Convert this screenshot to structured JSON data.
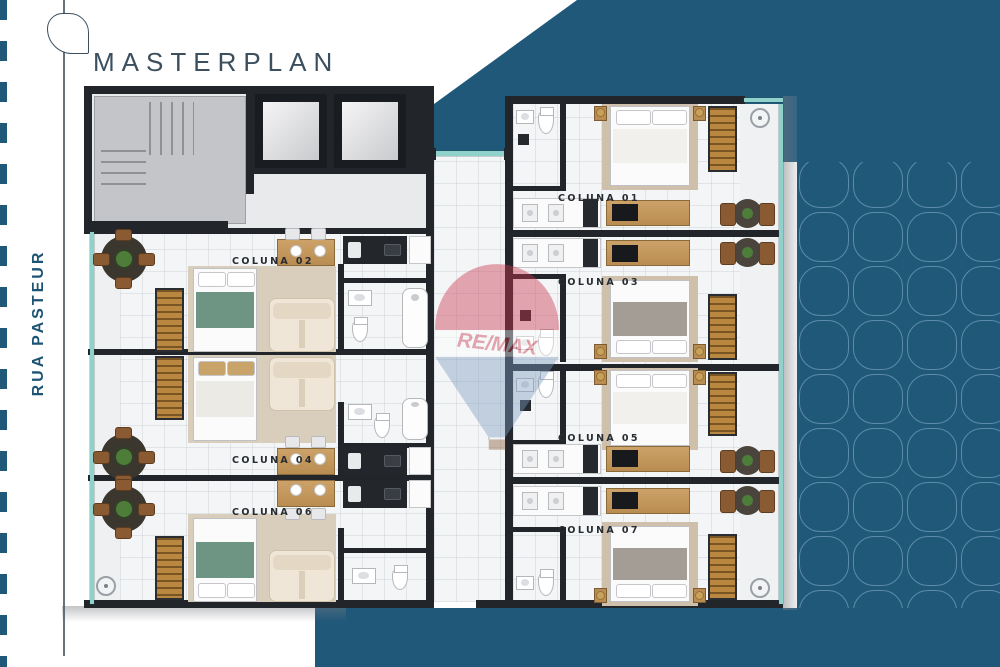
{
  "header": {
    "title": "MASTERPLAN"
  },
  "street": {
    "label": "RUA PASTEUR"
  },
  "watermark": {
    "brand": "RE/MAX"
  },
  "colors": {
    "blue": "#20587A",
    "pattern": "#5D8BAB",
    "street": "#1D5374",
    "labelc": "#282C31",
    "wall": "#22262B",
    "floor": "#F4F5F6",
    "glass": "#8FD2CC",
    "wood2": "#B9873F",
    "sofa": "#EFE6D7",
    "rug": "#D9CDBB",
    "bed_green": "#6E9484",
    "bed_gray": "#A39D96",
    "remax_red": "#C8374D",
    "remax_blue": "#7D9CC0"
  },
  "units": [
    {
      "id": "coluna-01",
      "label": "COLUNA 01",
      "x": 558,
      "y": 193
    },
    {
      "id": "coluna-02",
      "label": "COLUNA 02",
      "x": 232,
      "y": 256
    },
    {
      "id": "coluna-03",
      "label": "COLUNA 03",
      "x": 558,
      "y": 277
    },
    {
      "id": "coluna-04",
      "label": "COLUNA 04",
      "x": 232,
      "y": 455
    },
    {
      "id": "coluna-05",
      "label": "COLUNA 05",
      "x": 558,
      "y": 433
    },
    {
      "id": "coluna-06",
      "label": "COLUNA 06",
      "x": 232,
      "y": 507
    },
    {
      "id": "coluna-07",
      "label": "COLUNA 07",
      "x": 558,
      "y": 525
    }
  ],
  "plan": {
    "items": [
      {
        "t": "floor",
        "x": 92,
        "y": 94,
        "w": 336,
        "h": 138,
        "c": "#E9EAEC"
      },
      {
        "t": "floor",
        "x": 120,
        "y": 232,
        "w": 306,
        "h": 370
      },
      {
        "t": "floor",
        "x": 92,
        "y": 232,
        "w": 28,
        "h": 370,
        "c": "#EEF0F1"
      },
      {
        "t": "floor",
        "x": 434,
        "y": 156,
        "w": 71,
        "h": 446
      },
      {
        "t": "floor",
        "x": 513,
        "y": 104,
        "w": 227,
        "h": 498
      },
      {
        "t": "floor",
        "x": 740,
        "y": 104,
        "w": 41,
        "h": 498,
        "c": "#F0F1F2"
      },
      {
        "t": "shadow-b",
        "x": 62,
        "y": 606,
        "w": 284,
        "h": 16
      },
      {
        "t": "shadow-r",
        "x": 783,
        "y": 96,
        "w": 14,
        "h": 514
      },
      {
        "t": "stairs",
        "x": 94,
        "y": 96,
        "w": 152,
        "h": 128
      },
      {
        "t": "wall",
        "x": 246,
        "y": 86,
        "w": 8,
        "h": 108
      },
      {
        "t": "wall",
        "x": 88,
        "y": 221,
        "w": 140,
        "h": 7
      },
      {
        "t": "wall",
        "x": 248,
        "y": 86,
        "w": 186,
        "h": 88
      },
      {
        "t": "elevator",
        "x": 255,
        "y": 94,
        "w": 72,
        "h": 74
      },
      {
        "t": "elevator",
        "x": 334,
        "y": 94,
        "w": 72,
        "h": 74
      },
      {
        "t": "wall",
        "x": 84,
        "y": 86,
        "w": 350,
        "h": 8
      },
      {
        "t": "wall",
        "x": 84,
        "y": 86,
        "w": 8,
        "h": 146
      },
      {
        "t": "wall",
        "x": 426,
        "y": 86,
        "w": 8,
        "h": 522
      },
      {
        "t": "wall",
        "x": 84,
        "y": 600,
        "w": 350,
        "h": 8
      },
      {
        "t": "wall",
        "x": 84,
        "y": 228,
        "w": 350,
        "h": 6
      },
      {
        "t": "wall",
        "x": 88,
        "y": 349,
        "w": 346,
        "h": 6
      },
      {
        "t": "wall",
        "x": 88,
        "y": 475,
        "w": 346,
        "h": 6
      },
      {
        "t": "wall",
        "x": 338,
        "y": 264,
        "w": 6,
        "h": 86
      },
      {
        "t": "wall",
        "x": 338,
        "y": 278,
        "w": 96,
        "h": 5
      },
      {
        "t": "wall",
        "x": 338,
        "y": 402,
        "w": 6,
        "h": 74
      },
      {
        "t": "wall",
        "x": 338,
        "y": 443,
        "w": 96,
        "h": 5
      },
      {
        "t": "wall",
        "x": 338,
        "y": 528,
        "w": 6,
        "h": 74
      },
      {
        "t": "wall",
        "x": 338,
        "y": 548,
        "w": 96,
        "h": 5
      },
      {
        "t": "wall",
        "x": 505,
        "y": 96,
        "w": 240,
        "h": 8
      },
      {
        "t": "glass",
        "x": 744,
        "y": 98,
        "w": 39,
        "h": 4
      },
      {
        "t": "wall",
        "x": 505,
        "y": 96,
        "w": 8,
        "h": 512
      },
      {
        "t": "wall",
        "x": 476,
        "y": 600,
        "w": 307,
        "h": 8
      },
      {
        "t": "wall",
        "x": 505,
        "y": 230,
        "w": 278,
        "h": 7
      },
      {
        "t": "wall",
        "x": 505,
        "y": 364,
        "w": 278,
        "h": 7
      },
      {
        "t": "wall",
        "x": 505,
        "y": 477,
        "w": 278,
        "h": 7
      },
      {
        "t": "wall",
        "x": 560,
        "y": 104,
        "w": 6,
        "h": 84
      },
      {
        "t": "wall",
        "x": 513,
        "y": 186,
        "w": 53,
        "h": 5
      },
      {
        "t": "wall",
        "x": 560,
        "y": 278,
        "w": 6,
        "h": 84
      },
      {
        "t": "wall",
        "x": 513,
        "y": 274,
        "w": 53,
        "h": 5
      },
      {
        "t": "wall",
        "x": 560,
        "y": 371,
        "w": 6,
        "h": 72
      },
      {
        "t": "wall",
        "x": 513,
        "y": 440,
        "w": 53,
        "h": 5
      },
      {
        "t": "wall",
        "x": 560,
        "y": 530,
        "w": 6,
        "h": 72
      },
      {
        "t": "wall",
        "x": 513,
        "y": 527,
        "w": 53,
        "h": 5
      },
      {
        "t": "glass",
        "x": 436,
        "y": 151,
        "w": 70,
        "h": 5
      },
      {
        "t": "wall",
        "x": 428,
        "y": 148,
        "w": 8,
        "h": 12
      },
      {
        "t": "wall",
        "x": 504,
        "y": 148,
        "w": 9,
        "h": 12
      },
      {
        "t": "glass",
        "x": 90,
        "y": 232,
        "w": 4,
        "h": 372
      },
      {
        "t": "glass",
        "x": 779,
        "y": 104,
        "w": 4,
        "h": 500
      },
      {
        "t": "rug",
        "x": 188,
        "y": 266,
        "w": 148,
        "h": 86
      },
      {
        "t": "bed",
        "x": 193,
        "y": 268,
        "w": 64,
        "h": 84,
        "c": "#6E9484",
        "v": "t"
      },
      {
        "t": "wardrobe",
        "x": 155,
        "y": 288,
        "w": 29,
        "h": 64
      },
      {
        "t": "sofa",
        "x": 269,
        "y": 298,
        "w": 66,
        "h": 54
      },
      {
        "t": "wood",
        "x": 277,
        "y": 239,
        "w": 58,
        "h": 27
      },
      {
        "t": "chair",
        "x": 285,
        "y": 228,
        "w": 15,
        "h": 12
      },
      {
        "t": "chair",
        "x": 311,
        "y": 228,
        "w": 15,
        "h": 12
      },
      {
        "t": "plate",
        "x": 290,
        "y": 245,
        "w": 12,
        "h": 12
      },
      {
        "t": "plate",
        "x": 314,
        "y": 245,
        "w": 12,
        "h": 12
      },
      {
        "t": "kitchen",
        "x": 343,
        "y": 236,
        "w": 64,
        "h": 28
      },
      {
        "t": "counter",
        "x": 409,
        "y": 236,
        "w": 22,
        "h": 28
      },
      {
        "t": "table-round",
        "x": 101,
        "y": 236,
        "w": 46,
        "h": 46
      },
      {
        "t": "shower-tray",
        "x": 402,
        "y": 288,
        "w": 26,
        "h": 60
      },
      {
        "t": "sink",
        "x": 348,
        "y": 290,
        "w": 24,
        "h": 16
      },
      {
        "t": "toilet",
        "x": 352,
        "y": 320,
        "w": 16,
        "h": 22
      },
      {
        "t": "rug",
        "x": 188,
        "y": 355,
        "w": 148,
        "h": 88
      },
      {
        "t": "bed",
        "x": 193,
        "y": 357,
        "w": 64,
        "h": 84,
        "c": "#ECEAE5",
        "v": "t",
        "pc": "#C8A46A"
      },
      {
        "t": "wardrobe",
        "x": 155,
        "y": 356,
        "w": 29,
        "h": 64
      },
      {
        "t": "sofa",
        "x": 269,
        "y": 357,
        "w": 66,
        "h": 54
      },
      {
        "t": "wood",
        "x": 277,
        "y": 448,
        "w": 58,
        "h": 27
      },
      {
        "t": "chair",
        "x": 285,
        "y": 436,
        "w": 15,
        "h": 12
      },
      {
        "t": "chair",
        "x": 311,
        "y": 436,
        "w": 15,
        "h": 12
      },
      {
        "t": "plate",
        "x": 290,
        "y": 453,
        "w": 12,
        "h": 12
      },
      {
        "t": "plate",
        "x": 314,
        "y": 453,
        "w": 12,
        "h": 12
      },
      {
        "t": "kitchen",
        "x": 343,
        "y": 447,
        "w": 64,
        "h": 28
      },
      {
        "t": "counter",
        "x": 409,
        "y": 447,
        "w": 22,
        "h": 28
      },
      {
        "t": "table-round",
        "x": 101,
        "y": 434,
        "w": 46,
        "h": 46
      },
      {
        "t": "shower-tray",
        "x": 402,
        "y": 398,
        "w": 26,
        "h": 42
      },
      {
        "t": "sink",
        "x": 348,
        "y": 404,
        "w": 24,
        "h": 16
      },
      {
        "t": "toilet",
        "x": 374,
        "y": 416,
        "w": 16,
        "h": 22
      },
      {
        "t": "rug",
        "x": 188,
        "y": 514,
        "w": 148,
        "h": 88
      },
      {
        "t": "bed",
        "x": 193,
        "y": 518,
        "w": 64,
        "h": 84,
        "c": "#6E9484",
        "v": "b"
      },
      {
        "t": "wardrobe",
        "x": 155,
        "y": 536,
        "w": 29,
        "h": 64
      },
      {
        "t": "sofa",
        "x": 269,
        "y": 550,
        "w": 66,
        "h": 52
      },
      {
        "t": "wood",
        "x": 277,
        "y": 480,
        "w": 58,
        "h": 27
      },
      {
        "t": "chair",
        "x": 285,
        "y": 508,
        "w": 15,
        "h": 12
      },
      {
        "t": "chair",
        "x": 311,
        "y": 508,
        "w": 15,
        "h": 12
      },
      {
        "t": "plate",
        "x": 290,
        "y": 484,
        "w": 12,
        "h": 12
      },
      {
        "t": "plate",
        "x": 314,
        "y": 484,
        "w": 12,
        "h": 12
      },
      {
        "t": "kitchen",
        "x": 343,
        "y": 480,
        "w": 64,
        "h": 28
      },
      {
        "t": "counter",
        "x": 409,
        "y": 480,
        "w": 22,
        "h": 28
      },
      {
        "t": "table-round",
        "x": 101,
        "y": 486,
        "w": 46,
        "h": 46
      },
      {
        "t": "shower-head",
        "x": 96,
        "y": 576,
        "w": 20,
        "h": 20
      },
      {
        "t": "toilet",
        "x": 392,
        "y": 568,
        "w": 16,
        "h": 22
      },
      {
        "t": "sink",
        "x": 352,
        "y": 568,
        "w": 24,
        "h": 16
      },
      {
        "t": "mat",
        "x": 602,
        "y": 104,
        "w": 96,
        "h": 86
      },
      {
        "t": "bed",
        "x": 610,
        "y": 106,
        "w": 80,
        "h": 80,
        "c": "#F2F0EC",
        "v": "t"
      },
      {
        "t": "nstand",
        "x": 594,
        "y": 106,
        "w": 13,
        "h": 15
      },
      {
        "t": "nstand",
        "x": 693,
        "y": 106,
        "w": 13,
        "h": 15
      },
      {
        "t": "lamp",
        "x": 596,
        "y": 108,
        "w": 9,
        "h": 9
      },
      {
        "t": "lamp",
        "x": 695,
        "y": 108,
        "w": 9,
        "h": 9
      },
      {
        "t": "wardrobe",
        "x": 708,
        "y": 106,
        "w": 29,
        "h": 66
      },
      {
        "t": "shower-head",
        "x": 750,
        "y": 108,
        "w": 20,
        "h": 20
      },
      {
        "t": "toilet",
        "x": 538,
        "y": 110,
        "w": 16,
        "h": 24
      },
      {
        "t": "sink",
        "x": 516,
        "y": 110,
        "w": 18,
        "h": 14
      },
      {
        "t": "appl",
        "x": 518,
        "y": 134,
        "w": 11,
        "h": 11
      },
      {
        "t": "counter",
        "x": 513,
        "y": 198,
        "w": 88,
        "h": 30
      },
      {
        "t": "sinksq",
        "x": 522,
        "y": 204,
        "w": 16,
        "h": 18
      },
      {
        "t": "sinksq",
        "x": 548,
        "y": 204,
        "w": 16,
        "h": 18
      },
      {
        "t": "appl",
        "x": 583,
        "y": 199,
        "w": 15,
        "h": 28
      },
      {
        "t": "wood",
        "x": 606,
        "y": 200,
        "w": 84,
        "h": 26
      },
      {
        "t": "tv",
        "x": 612,
        "y": 204,
        "w": 26,
        "h": 17
      },
      {
        "t": "bistro",
        "x": 733,
        "y": 199,
        "w": 29,
        "h": 29
      },
      {
        "t": "counter",
        "x": 513,
        "y": 238,
        "w": 88,
        "h": 30
      },
      {
        "t": "sinksq",
        "x": 522,
        "y": 244,
        "w": 16,
        "h": 18
      },
      {
        "t": "sinksq",
        "x": 548,
        "y": 244,
        "w": 16,
        "h": 18
      },
      {
        "t": "appl",
        "x": 583,
        "y": 239,
        "w": 15,
        "h": 28
      },
      {
        "t": "wood",
        "x": 606,
        "y": 240,
        "w": 84,
        "h": 26
      },
      {
        "t": "tv",
        "x": 612,
        "y": 245,
        "w": 26,
        "h": 17
      },
      {
        "t": "bistro",
        "x": 733,
        "y": 238,
        "w": 29,
        "h": 29
      },
      {
        "t": "mat",
        "x": 602,
        "y": 276,
        "w": 96,
        "h": 86
      },
      {
        "t": "bed",
        "x": 610,
        "y": 280,
        "w": 80,
        "h": 78,
        "c": "#A39D96",
        "v": "b"
      },
      {
        "t": "nstand",
        "x": 594,
        "y": 344,
        "w": 13,
        "h": 15
      },
      {
        "t": "nstand",
        "x": 693,
        "y": 344,
        "w": 13,
        "h": 15
      },
      {
        "t": "lamp",
        "x": 596,
        "y": 347,
        "w": 9,
        "h": 9
      },
      {
        "t": "lamp",
        "x": 695,
        "y": 347,
        "w": 9,
        "h": 9
      },
      {
        "t": "wardrobe",
        "x": 708,
        "y": 294,
        "w": 29,
        "h": 66
      },
      {
        "t": "toilet",
        "x": 538,
        "y": 332,
        "w": 16,
        "h": 24
      },
      {
        "t": "sink",
        "x": 516,
        "y": 336,
        "w": 18,
        "h": 14
      },
      {
        "t": "appl",
        "x": 520,
        "y": 310,
        "w": 11,
        "h": 11
      },
      {
        "t": "mat",
        "x": 602,
        "y": 368,
        "w": 96,
        "h": 82
      },
      {
        "t": "bed",
        "x": 610,
        "y": 370,
        "w": 80,
        "h": 76,
        "c": "#F2F0EC",
        "v": "t"
      },
      {
        "t": "nstand",
        "x": 594,
        "y": 370,
        "w": 13,
        "h": 15
      },
      {
        "t": "nstand",
        "x": 693,
        "y": 370,
        "w": 13,
        "h": 15
      },
      {
        "t": "lamp",
        "x": 596,
        "y": 372,
        "w": 9,
        "h": 9
      },
      {
        "t": "lamp",
        "x": 695,
        "y": 372,
        "w": 9,
        "h": 9
      },
      {
        "t": "wardrobe",
        "x": 708,
        "y": 372,
        "w": 29,
        "h": 64
      },
      {
        "t": "toilet",
        "x": 538,
        "y": 374,
        "w": 16,
        "h": 24
      },
      {
        "t": "sink",
        "x": 516,
        "y": 378,
        "w": 18,
        "h": 14
      },
      {
        "t": "appl",
        "x": 520,
        "y": 400,
        "w": 11,
        "h": 11
      },
      {
        "t": "counter",
        "x": 513,
        "y": 444,
        "w": 88,
        "h": 30
      },
      {
        "t": "sinksq",
        "x": 522,
        "y": 450,
        "w": 16,
        "h": 18
      },
      {
        "t": "sinksq",
        "x": 548,
        "y": 450,
        "w": 16,
        "h": 18
      },
      {
        "t": "appl",
        "x": 583,
        "y": 445,
        "w": 15,
        "h": 28
      },
      {
        "t": "wood",
        "x": 606,
        "y": 446,
        "w": 84,
        "h": 26
      },
      {
        "t": "tv",
        "x": 612,
        "y": 450,
        "w": 26,
        "h": 17
      },
      {
        "t": "bistro",
        "x": 733,
        "y": 446,
        "w": 29,
        "h": 29
      },
      {
        "t": "counter",
        "x": 513,
        "y": 486,
        "w": 88,
        "h": 30
      },
      {
        "t": "sinksq",
        "x": 522,
        "y": 492,
        "w": 16,
        "h": 18
      },
      {
        "t": "sinksq",
        "x": 548,
        "y": 492,
        "w": 16,
        "h": 18
      },
      {
        "t": "appl",
        "x": 583,
        "y": 487,
        "w": 15,
        "h": 28
      },
      {
        "t": "wood",
        "x": 606,
        "y": 488,
        "w": 84,
        "h": 26
      },
      {
        "t": "tv",
        "x": 612,
        "y": 492,
        "w": 26,
        "h": 17
      },
      {
        "t": "bistro",
        "x": 733,
        "y": 486,
        "w": 29,
        "h": 29
      },
      {
        "t": "mat",
        "x": 602,
        "y": 522,
        "w": 96,
        "h": 84
      },
      {
        "t": "bed",
        "x": 610,
        "y": 526,
        "w": 80,
        "h": 76,
        "c": "#A39D96",
        "v": "b"
      },
      {
        "t": "nstand",
        "x": 594,
        "y": 588,
        "w": 13,
        "h": 15
      },
      {
        "t": "nstand",
        "x": 693,
        "y": 588,
        "w": 13,
        "h": 15
      },
      {
        "t": "lamp",
        "x": 596,
        "y": 591,
        "w": 9,
        "h": 9
      },
      {
        "t": "lamp",
        "x": 695,
        "y": 591,
        "w": 9,
        "h": 9
      },
      {
        "t": "wardrobe",
        "x": 708,
        "y": 534,
        "w": 29,
        "h": 66
      },
      {
        "t": "toilet",
        "x": 538,
        "y": 572,
        "w": 16,
        "h": 24
      },
      {
        "t": "sink",
        "x": 516,
        "y": 576,
        "w": 18,
        "h": 14
      },
      {
        "t": "shower-head",
        "x": 750,
        "y": 578,
        "w": 20,
        "h": 20
      }
    ]
  }
}
